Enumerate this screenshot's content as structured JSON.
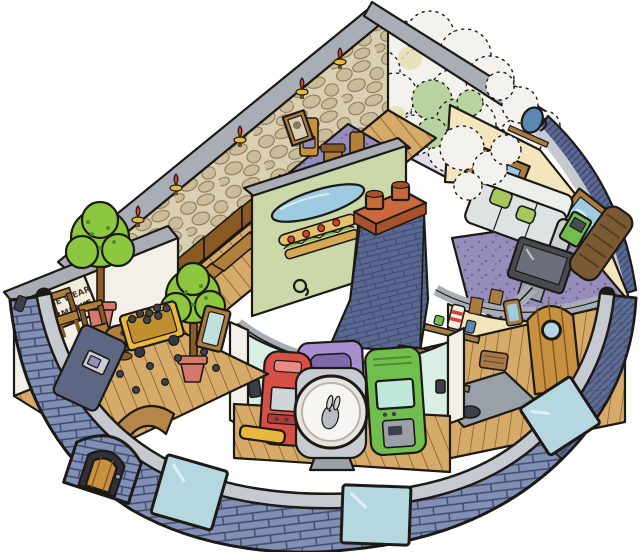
{
  "illustration": {
    "style": "isometric cutaway ink-and-watercolor drawing",
    "subject": "fan-shaped round brick building with roof removed showing six rooms around a white central courtyard and a brick chimney",
    "sign": {
      "line1": "PLEASE WEAR",
      "line2": "A YARMULKE"
    },
    "rooms": [
      {
        "name": "sanctuary",
        "wall": "cobblestone with flaming candle sconces",
        "contents": [
          "wooden pews",
          "raised purple platform with steps",
          "high-back chair",
          "lectern",
          "second chair",
          "framed portrait"
        ]
      },
      {
        "name": "steam-room",
        "contents": [
          "billowing white steam clouds",
          "green steam cloud",
          "steam spilling over walls"
        ]
      },
      {
        "name": "tv-lounge",
        "contents": [
          "two framed seascape pictures",
          "shelf with blue jug",
          "grey couch with green pillows",
          "purple speckled carpet",
          "television on stand",
          "green console",
          "tall speaker cabinet"
        ]
      },
      {
        "name": "pantry-kitchen",
        "contents": [
          "shelves with striped jar and cups",
          "fruit shelf",
          "basket",
          "grey hearth with bowl",
          "firewood logs",
          "sailboat painting",
          "round-top wooden door with porthole",
          "small mirror"
        ]
      },
      {
        "name": "arcade",
        "contents": [
          "red arcade cabinet",
          "purple arcade cabinet",
          "porthole machine with rabbit inside",
          "green arcade cabinet",
          "yellow floor mat",
          "wall sconces"
        ]
      },
      {
        "name": "lobby",
        "contents": [
          "please-wear-a-yarmulke sign",
          "two potted trees in pink pots",
          "two wooden chairs",
          "round pedestal table",
          "yellow cart full of berries",
          "berries scattered on floor",
          "leaning mirror",
          "arched floor opening"
        ]
      }
    ],
    "exterior": [
      "curved blue-grey brick wall",
      "grey stone coping",
      "pale blue windows",
      "brick entry vestibule with wooden door",
      "side door with metal latch",
      "mail slot",
      "central brick chimney with two terracotta pots",
      "oval window on green courtyard wall",
      "sandwich-shaped deli sign",
      "wall spigot"
    ]
  },
  "palette": {
    "paper": "#ffffff",
    "ink": "#1d1a16",
    "brickLight": "#97a3c4",
    "brickMid": "#8190b4",
    "brickDark": "#5a6790",
    "brickLine": "#3e4a6e",
    "coping": "#a9adb5",
    "copingLight": "#c6c9cf",
    "stoneWall": "#d9cfb2",
    "stoneStone": "#cbbd9c",
    "woodFloor": "#d6aa68",
    "woodDark": "#8a5a25",
    "woodLine": "#7c5020",
    "pew": "#b07f3a",
    "carpetPurple": "#968dbd",
    "steamWhite": "#f4f2ee",
    "steamShade": "#dfdcea",
    "steamGreen": "#b9d3a0",
    "steamYellow": "#e7dcb0",
    "mintWall": "#d9efe6",
    "creamWall": "#f4e6bc",
    "whiteWall": "#f3f0e7",
    "courtyardGreen": "#cbd9a9",
    "windowBlue": "#b5d8e0",
    "ovalBlue": "#9ecbe0",
    "treeGreen": "#8dc63f",
    "treeDark": "#4e8c2f",
    "potPink": "#d4796b",
    "cabRed": "#d84f48",
    "cabPurple": "#a88fd0",
    "cabGreen": "#6fbe4e",
    "machineGrey": "#c7ccd3",
    "couchGrey": "#dde2e2",
    "pillowGreen": "#a7c85e",
    "tvDark": "#4a4a52",
    "chimneyCap": "#c96a3e",
    "chimneyCapDark": "#a9502c",
    "doorWood": "#c8913f",
    "signPaper": "#f1ecdc",
    "frameBrown": "#a97c42",
    "flameRed": "#d8402e",
    "hearthGrey": "#9aa0a8",
    "berryDark": "#3f4350",
    "cartYellow": "#e8b93c",
    "jugBlue": "#5b87b5",
    "speakerBrown": "#7a5a33",
    "doorGrey": "#5d6784",
    "silver": "#c9ccd2",
    "darkFixture": "#3c3f4a"
  }
}
